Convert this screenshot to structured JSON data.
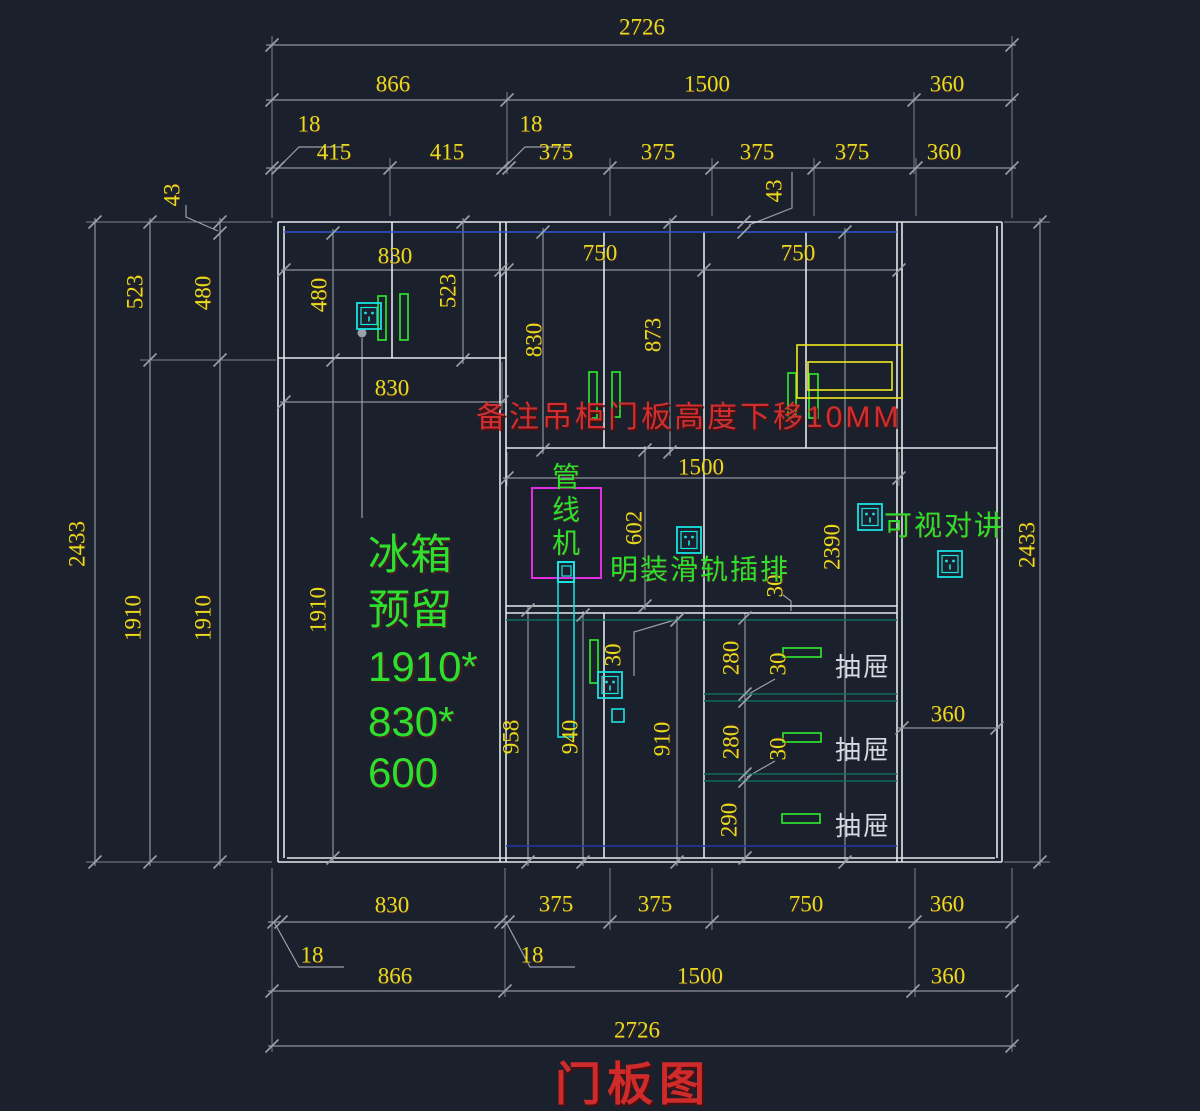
{
  "title": "门板图",
  "note": "备注吊柜门板高度下移10MM",
  "fridge_note": {
    "line1": "冰箱",
    "line2": "预留",
    "line3": "1910*",
    "line4": "830*",
    "line5": "600"
  },
  "green_labels": {
    "pipe_machine": "管线机",
    "rail_socket": "明装滑轨插排",
    "video_intercom": "可视对讲"
  },
  "drawer_labels": {
    "drawer1": "抽屉",
    "drawer2": "抽屉",
    "drawer3": "抽屉"
  },
  "icons": {
    "socket": "power-socket-icon",
    "handle": "door-handle-icon",
    "hood": "range-hood-outline",
    "pipe": "water-pipe",
    "pipe_box": "pipe-machine-box"
  },
  "colors": {
    "background": "#1b212c",
    "cabinet_line": "#e3e7eb",
    "dim_line": "#8e949b",
    "dim_text": "#e3df1e",
    "green": "#2ee02e",
    "cyan": "#19e2e2",
    "magenta": "#e02ee0",
    "yellow_shape": "#e3df1e",
    "red": "#d02f2f",
    "blue_top": "#3353d6",
    "blue_toe": "#2636a8",
    "teal": "#0e6b5f"
  },
  "dims": {
    "top_2726": "2726",
    "top_866": "866",
    "top_1500": "1500",
    "top_360": "360",
    "top_18_left": "18",
    "top_18_mid": "18",
    "top_415_1": "415",
    "top_415_2": "415",
    "top_375_1": "375",
    "top_375_2": "375",
    "top_375_3": "375",
    "top_375_4": "375",
    "top_360_b": "360",
    "top_43": "43",
    "left_43": "43",
    "left_523": "523",
    "left_480": "480",
    "left_2433": "2433",
    "left_1910_a": "1910",
    "left_1910_b": "1910",
    "inner_830_top": "830",
    "inner_480": "480",
    "inner_523": "523",
    "inner_830_bot": "830",
    "inner_1910": "1910",
    "mid_750_a": "750",
    "mid_750_b": "750",
    "mid_830": "830",
    "mid_873": "873",
    "mid_1500": "1500",
    "mid_602": "602",
    "mid_2390": "2390",
    "mid_30_counter": "30",
    "mid_30_handle": "30",
    "low_958": "958",
    "low_940": "940",
    "low_910": "910",
    "low_280_a": "280",
    "low_280_b": "280",
    "low_290": "290",
    "low_30_a": "30",
    "low_30_b": "30",
    "right_360": "360",
    "right_2433": "2433",
    "bot_830": "830",
    "bot_375_a": "375",
    "bot_375_b": "375",
    "bot_750": "750",
    "bot_360_a": "360",
    "bot_18_left": "18",
    "bot_18_mid": "18",
    "bot_866": "866",
    "bot_1500": "1500",
    "bot_360_b": "360",
    "bot_2726": "2726"
  }
}
